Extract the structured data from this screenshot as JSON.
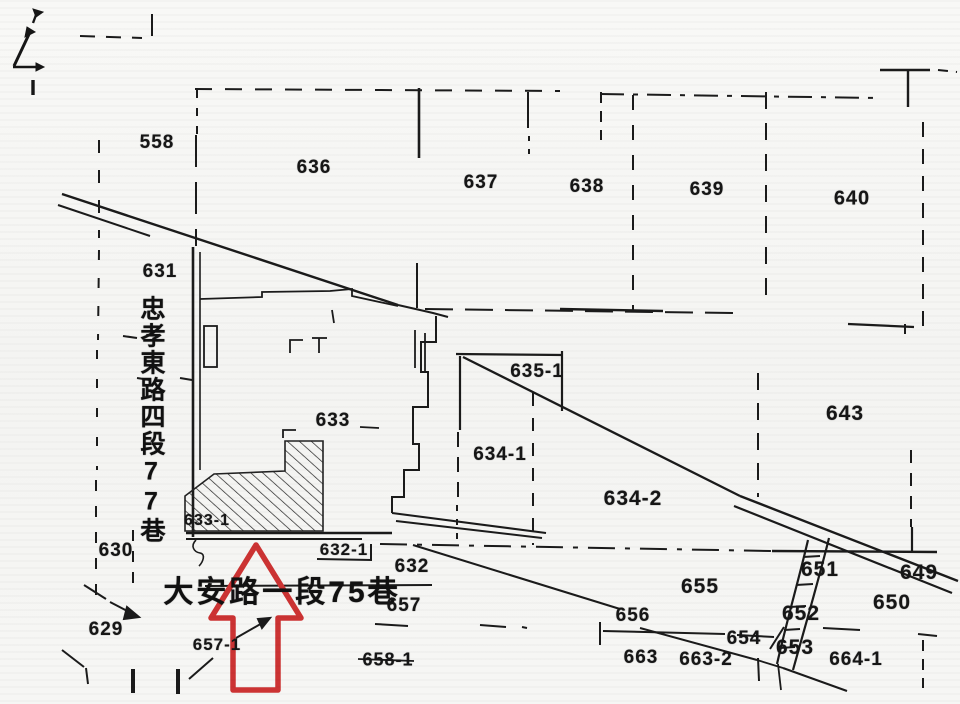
{
  "map": {
    "title": "cadastral parcel map",
    "ink_color": "#1b1b1b",
    "highlight_color": "#cc3333",
    "streets": {
      "vertical": {
        "name": "忠孝東路四段77巷",
        "x": 151,
        "y": 420
      },
      "horizontal": {
        "name": "大安路一段75巷",
        "x": 282,
        "y": 589
      }
    },
    "highlighted_parcel": "633-1",
    "parcels": [
      {
        "id": "558",
        "x": 157,
        "y": 143,
        "fs": 19
      },
      {
        "id": "636",
        "x": 314,
        "y": 168,
        "fs": 19
      },
      {
        "id": "637",
        "x": 481,
        "y": 183,
        "fs": 19
      },
      {
        "id": "638",
        "x": 587,
        "y": 187,
        "fs": 19
      },
      {
        "id": "639",
        "x": 707,
        "y": 190,
        "fs": 19
      },
      {
        "id": "640",
        "x": 852,
        "y": 199,
        "fs": 20
      },
      {
        "id": "631",
        "x": 160,
        "y": 272,
        "fs": 19
      },
      {
        "id": "633",
        "x": 333,
        "y": 421,
        "fs": 19
      },
      {
        "id": "635-1",
        "x": 537,
        "y": 372,
        "fs": 19
      },
      {
        "id": "634-1",
        "x": 500,
        "y": 455,
        "fs": 19
      },
      {
        "id": "634-2",
        "x": 633,
        "y": 499,
        "fs": 21
      },
      {
        "id": "643",
        "x": 845,
        "y": 414,
        "fs": 21
      },
      {
        "id": "633-1",
        "x": 207,
        "y": 521,
        "fs": 16
      },
      {
        "id": "632-1",
        "x": 344,
        "y": 550,
        "fs": 17
      },
      {
        "id": "632",
        "x": 412,
        "y": 567,
        "fs": 19
      },
      {
        "id": "657",
        "x": 404,
        "y": 606,
        "fs": 19
      },
      {
        "id": "658-1",
        "x": 388,
        "y": 660,
        "fs": 18
      },
      {
        "id": "630",
        "x": 116,
        "y": 551,
        "fs": 19
      },
      {
        "id": "629",
        "x": 106,
        "y": 630,
        "fs": 19
      },
      {
        "id": "657-1",
        "x": 217,
        "y": 645,
        "fs": 17
      },
      {
        "id": "655",
        "x": 700,
        "y": 587,
        "fs": 21
      },
      {
        "id": "651",
        "x": 820,
        "y": 570,
        "fs": 21
      },
      {
        "id": "649",
        "x": 919,
        "y": 573,
        "fs": 21
      },
      {
        "id": "650",
        "x": 892,
        "y": 603,
        "fs": 21
      },
      {
        "id": "652",
        "x": 801,
        "y": 614,
        "fs": 21
      },
      {
        "id": "656",
        "x": 633,
        "y": 616,
        "fs": 19
      },
      {
        "id": "654",
        "x": 744,
        "y": 639,
        "fs": 19
      },
      {
        "id": "653",
        "x": 795,
        "y": 648,
        "fs": 21
      },
      {
        "id": "663",
        "x": 641,
        "y": 658,
        "fs": 19
      },
      {
        "id": "663-2",
        "x": 706,
        "y": 660,
        "fs": 19
      },
      {
        "id": "664-1",
        "x": 856,
        "y": 660,
        "fs": 19
      }
    ]
  }
}
